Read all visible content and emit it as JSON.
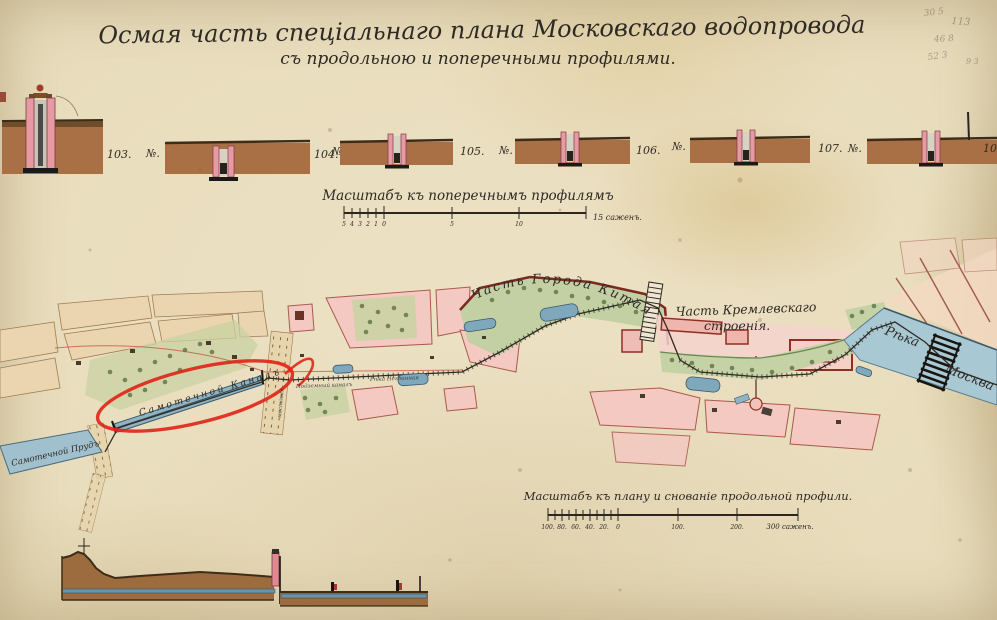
{
  "title": {
    "line1": "Осмая часть спеціальнаго плана Московскаго водопровода",
    "line2": "съ продольною и поперечными профилями."
  },
  "cross_profiles": {
    "section_numbers": [
      "103.",
      "104.",
      "105.",
      "106.",
      "107.",
      "108"
    ],
    "number_sign": "№."
  },
  "scale_cross": {
    "title": "Масштабъ къ поперечнымъ профилямъ",
    "minor_ticks": [
      "5",
      "4",
      "3",
      "2",
      "1",
      "0"
    ],
    "major_ticks": [
      "5",
      "10"
    ],
    "end_label": "15 саженъ."
  },
  "scale_plan": {
    "title": "Масштабъ къ плану и снованіе продольной профили.",
    "minor_ticks": [
      "100.",
      "80.",
      "60.",
      "40.",
      "20.",
      "0"
    ],
    "major_ticks": [
      "100.",
      "200."
    ],
    "end_label": "300 саженъ."
  },
  "map_labels": {
    "kitay_gorod": "Часть Города Китая",
    "kremlin_line1": "Часть Кремлевскаго",
    "kremlin_line2": "строенія.",
    "river_word1": "Рѣка",
    "river_word2": "Москва",
    "canal": "Самотечной Каналъ",
    "pond": "Самотечной Прудъ",
    "canal_small_1": "Подземный каналъ",
    "canal_small_2": "Рѣка Неглинная",
    "street": "мостовая"
  },
  "pencil_notes": [
    "30 5",
    "113",
    "46 8",
    "52 3",
    "9 3"
  ],
  "colors": {
    "paper": "#e8dcba",
    "ink": "#2e2a24",
    "earth": "#a87044",
    "pink_block": "#f3c9c2",
    "green_area": "#c8d2a2",
    "water": "#a8c8d4",
    "annotation_red": "#e0261a",
    "wall_red": "#8e2f23"
  }
}
